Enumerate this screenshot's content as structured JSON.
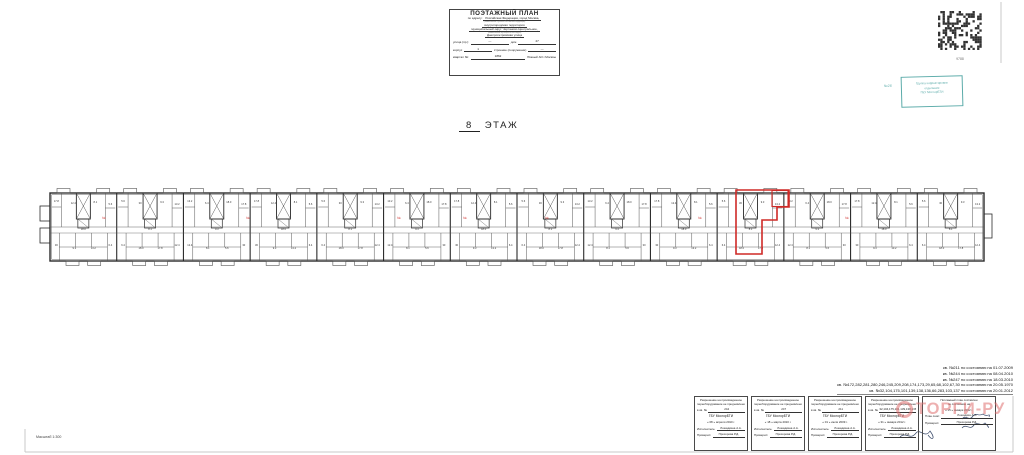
{
  "colors": {
    "teal": "#3f9d9b",
    "red": "#cf2a27",
    "watermark": "#e07070",
    "wall": "#2a2a2a",
    "thin": "#555555",
    "frame": "#c9c9c9",
    "speck": "#333333",
    "signature": "#3a4a6a"
  },
  "title_block": {
    "title": "ПОЭТАЖНЫЙ ПЛАН",
    "address_label": "по адресу:",
    "line1": "Российская Федерация, город Москва,",
    "caption1": "(наименование субъекта Российской Федерации)",
    "line2": "внутригородская территория",
    "line3": "муниципальный округ Чертаново Центральное,",
    "caption2": "(наименование муниципального округа)",
    "line4": "Днепропетровская улица",
    "row1_label": "улица (пр.):",
    "row1_blank": "—",
    "row1_house_label": "дом",
    "row1_house": "27",
    "row2_label": "корпус",
    "row2_value": "1",
    "row2_label2": "строение (сооружение)",
    "row2_value2": "—",
    "row3_label": "квартал №:",
    "row3_value": "1862",
    "row3_right": "Южный АО г.Москвы"
  },
  "floor_label": {
    "number": "8",
    "word": "ЭТАЖ"
  },
  "qr": {
    "number": "9788"
  },
  "teal_stamp": {
    "line1": "Группа корректировки",
    "line2": "отделение",
    "line3": "ГБУ МосгорБТИ",
    "side_mark": "№2б"
  },
  "annotations": {
    "lines": [
      "кв. №211 по состоянию на 01.07.2009",
      "кв. №244 по состоянию на 08.04.2010",
      "кв. №247 по состоянию на 18.03.2010",
      "кв. №172,282,281,280,246,245,209,208,174,173,29,65,68,102,67,30 по состоянию на 20.05.1970",
      "кв. №32,104,175,101,139,138,136,66,283,103,137 по состоянию на 20.01.2012"
    ]
  },
  "stamps": {
    "permission_line1": "Разрешение на произведенное",
    "permission_line2": "переоборудование не предъявлено",
    "kv_label": "в кв. №",
    "org": "ГБУ МосгорБТИ",
    "executor_label": "Исполнитель:",
    "checker_label": "Проверил:",
    "boxes": [
      {
        "kv": "244",
        "date": "« 08 » апреля 2010 г.",
        "executor": "Лошадкина А.А.",
        "checker": "Прохорова Р.Д."
      },
      {
        "kv": "247",
        "date": "« 18 » марта 2010 г.",
        "executor": "Лошадкина А.А.",
        "checker": "Прохорова Р.Д."
      },
      {
        "kv": "211",
        "date": "« 01 » июля 2009 г.",
        "executor": "Лошадкина А.А.",
        "checker": "Прохорова Р.Д."
      },
      {
        "kv": "32,104,175,101,139,138,136",
        "date": "« 31 » января 2012 г.",
        "executor": "Лошадкина А.А.",
        "checker": "Прохорова Р.Д."
      }
    ],
    "final": {
      "title1": "Поэтажный план составлен",
      "title2": "по состоянию на",
      "date": "« 15 » января 2012 г.",
      "row1_label": "План снял:",
      "row1_name": "Лошадкин А.А.",
      "row2_label": "Проверил:",
      "row2_name": "Прохорова Р.Д."
    }
  },
  "scale_label": "Масштаб 1:300",
  "watermark": {
    "text": "ТОРГИ-РУ"
  },
  "plan": {
    "x0": 50,
    "x1": 984,
    "y_top": 193,
    "y_bottom": 261,
    "corridor_y1": 227,
    "corridor_y2": 233,
    "sections": 14,
    "core": {
      "width": 14,
      "height": 26,
      "sub_height": 9
    },
    "balcony": {
      "w": 13,
      "h": 4.5
    },
    "speck_labels": [
      "17.8",
      "12.4",
      "8.1",
      "5.6",
      "30",
      "9.3",
      "13.2",
      "6.4",
      "18.0"
    ],
    "speck_offsets": [
      [
        -27,
        9
      ],
      [
        -10,
        11
      ],
      [
        12,
        10
      ],
      [
        27,
        12
      ],
      [
        -27,
        53
      ],
      [
        -9,
        56
      ],
      [
        10,
        56
      ],
      [
        27,
        53
      ],
      [
        0,
        37
      ]
    ],
    "red_unit": {
      "outline": [
        [
          736,
          190
        ],
        [
          789,
          190
        ],
        [
          789,
          207
        ],
        [
          777,
          207
        ],
        [
          777,
          220
        ],
        [
          762,
          220
        ],
        [
          762,
          254
        ],
        [
          736,
          254
        ]
      ],
      "inner_rect": [
        772,
        190.5,
        16,
        16
      ]
    },
    "red_marks": {
      "glyph": "№",
      "xs": [
        104,
        248,
        399,
        465,
        547,
        700,
        847
      ],
      "y": 219
    },
    "end_caps": [
      [
        40,
        206,
        10,
        15
      ],
      [
        40,
        228,
        10,
        15
      ],
      [
        984,
        214,
        8,
        24
      ]
    ],
    "frame_lines": [
      [
        25,
        452,
        1013,
        452
      ],
      [
        25,
        429,
        25,
        452
      ],
      [
        1013,
        396,
        1013,
        452
      ],
      [
        1001,
        2,
        1001,
        63
      ]
    ],
    "signatures": [
      "M962,419 c4,-5 7,3 11,-3 c3,-4 6,1 10,-2 c4,4 8,-2 6,3",
      "M962,428 c4,-5 8,3 12,-3 c3,-4 7,2 11,-2 c5,5 4,6 2,2",
      "M900,437 c6,-6 10,4 16,-4 c4,-5 9,6 14,-2 c6,8 2,10 -2,4"
    ]
  }
}
